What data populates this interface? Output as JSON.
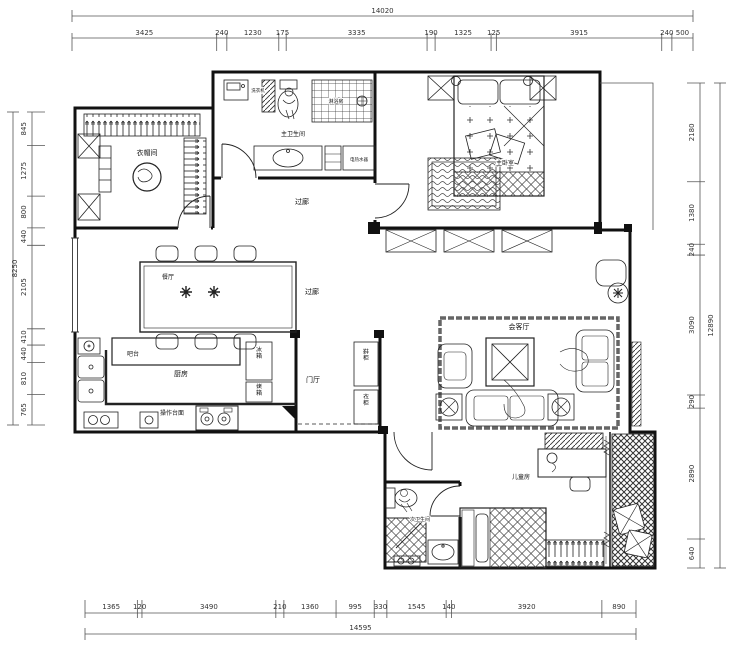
{
  "drawing": {
    "type": "residential floor plan",
    "unit": "mm",
    "line_color": "#1a1a1a",
    "background": "#ffffff"
  },
  "labels": {
    "cloakroom": "衣帽间",
    "master_bath": "主卫生间",
    "shower_room": "淋浴房",
    "washing_machine": "洗衣机",
    "water_heater": "电热水器",
    "master_bedroom": "主卧室",
    "corridor_top": "过廊",
    "corridor_mid": "过廊",
    "dining": "餐厅",
    "bar": "吧台",
    "kitchen": "厨房",
    "counter": "操作台面",
    "fridge": "冰箱",
    "oven": "烤箱",
    "hall": "门厅",
    "shoe_cabinet": "鞋柜",
    "closet": "衣柜",
    "living": "会客厅",
    "kids": "儿童房",
    "second_bath": "次卫生间"
  },
  "dimensions": {
    "top": {
      "total": "14020",
      "segments": [
        "3425",
        "240",
        "1230",
        "175",
        "3335",
        "190",
        "1325",
        "125",
        "3915",
        "240",
        "500"
      ]
    },
    "bottom": {
      "total": "14595",
      "segments": [
        "1365",
        "120",
        "3490",
        "210",
        "1360",
        "995",
        "330",
        "1545",
        "140",
        "3920",
        "890"
      ]
    },
    "left": {
      "total": "8250",
      "segments": [
        "845",
        "1275",
        "800",
        "440",
        "2105",
        "410",
        "440",
        "810",
        "765"
      ]
    },
    "right": {
      "total": "12890",
      "segments": [
        "2180",
        "1380",
        "240",
        "3090",
        "290",
        "2890",
        "640"
      ]
    }
  }
}
